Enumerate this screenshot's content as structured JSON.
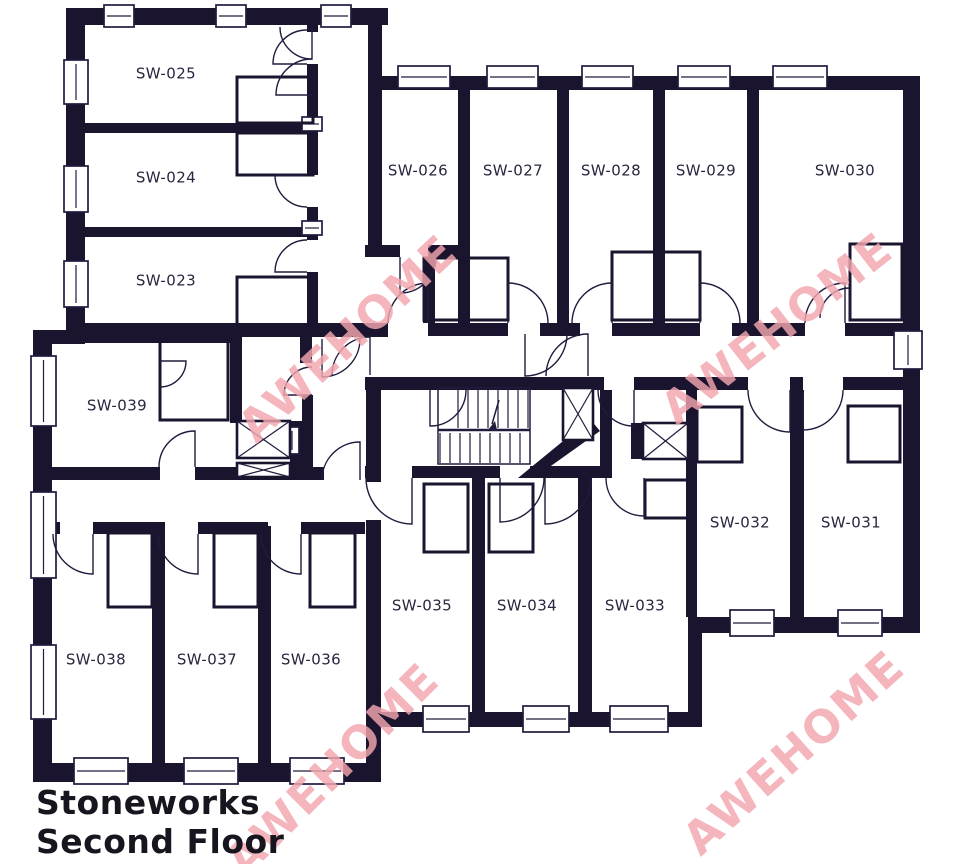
{
  "title": {
    "line1": "Stoneworks",
    "line2": "Second Floor"
  },
  "watermark_text": "AWEHOME",
  "rooms": [
    "SW-023",
    "SW-024",
    "SW-025",
    "SW-026",
    "SW-027",
    "SW-028",
    "SW-029",
    "SW-030",
    "SW-031",
    "SW-032",
    "SW-033",
    "SW-034",
    "SW-035",
    "SW-036",
    "SW-037",
    "SW-038",
    "SW-039"
  ],
  "colors": {
    "wall": "#1a142f",
    "line": "#221b3d",
    "label": "#2b2540",
    "title": "#17151e",
    "watermark": "#f2a6ae",
    "background": "#ffffff"
  }
}
